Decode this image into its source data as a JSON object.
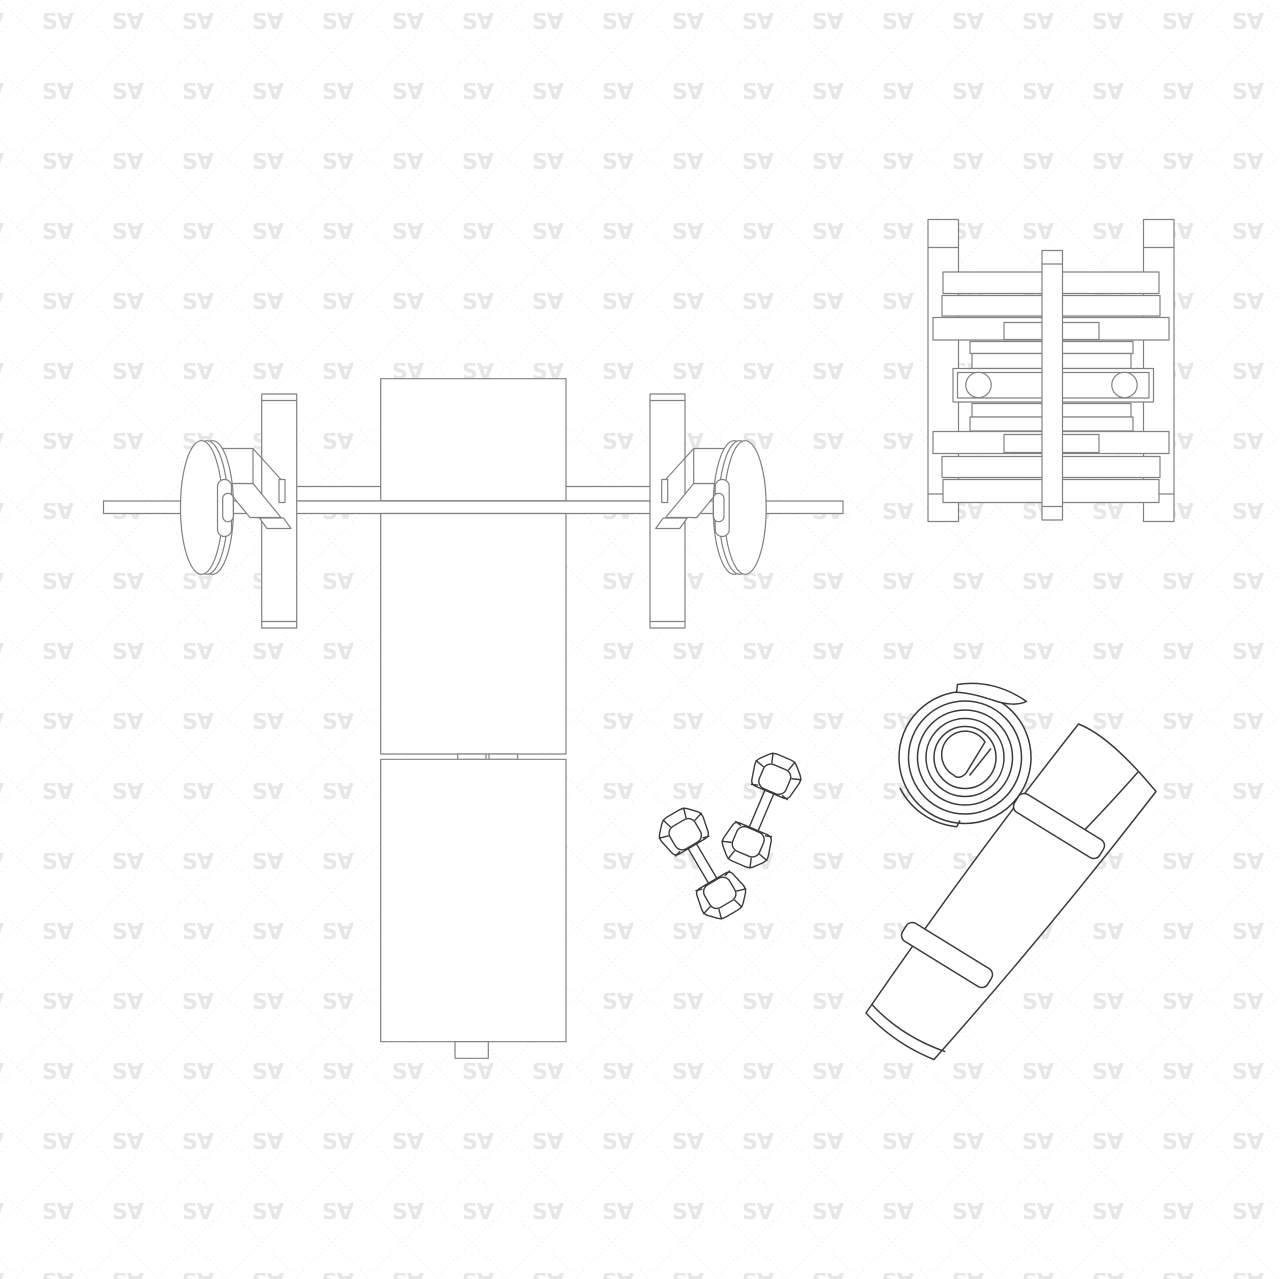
{
  "canvas": {
    "width": 1280,
    "height": 1279,
    "background": "#ffffff"
  },
  "watermark": {
    "text": "S∀",
    "logo_color": "#e7e7e7",
    "lattice_color": "#efefef",
    "tile_size": 70
  },
  "drawing": {
    "furniture_line_color": "#818181",
    "accessory_line_color": "#3a3a3a",
    "fill_color": "#ffffff",
    "items": [
      {
        "id": "bench-press-barbell",
        "label": "flat bench with barbell and weight plates, top view"
      },
      {
        "id": "plate-rack",
        "label": "weight plate storage rack, top view"
      },
      {
        "id": "hex-dumbbells",
        "label": "pair of hex dumbbells, top view"
      },
      {
        "id": "yoga-mat-rolled-top",
        "label": "rolled yoga mat, top view spiral"
      },
      {
        "id": "yoga-mat-rolled-side",
        "label": "rolled yoga mat with straps, side view"
      }
    ]
  }
}
